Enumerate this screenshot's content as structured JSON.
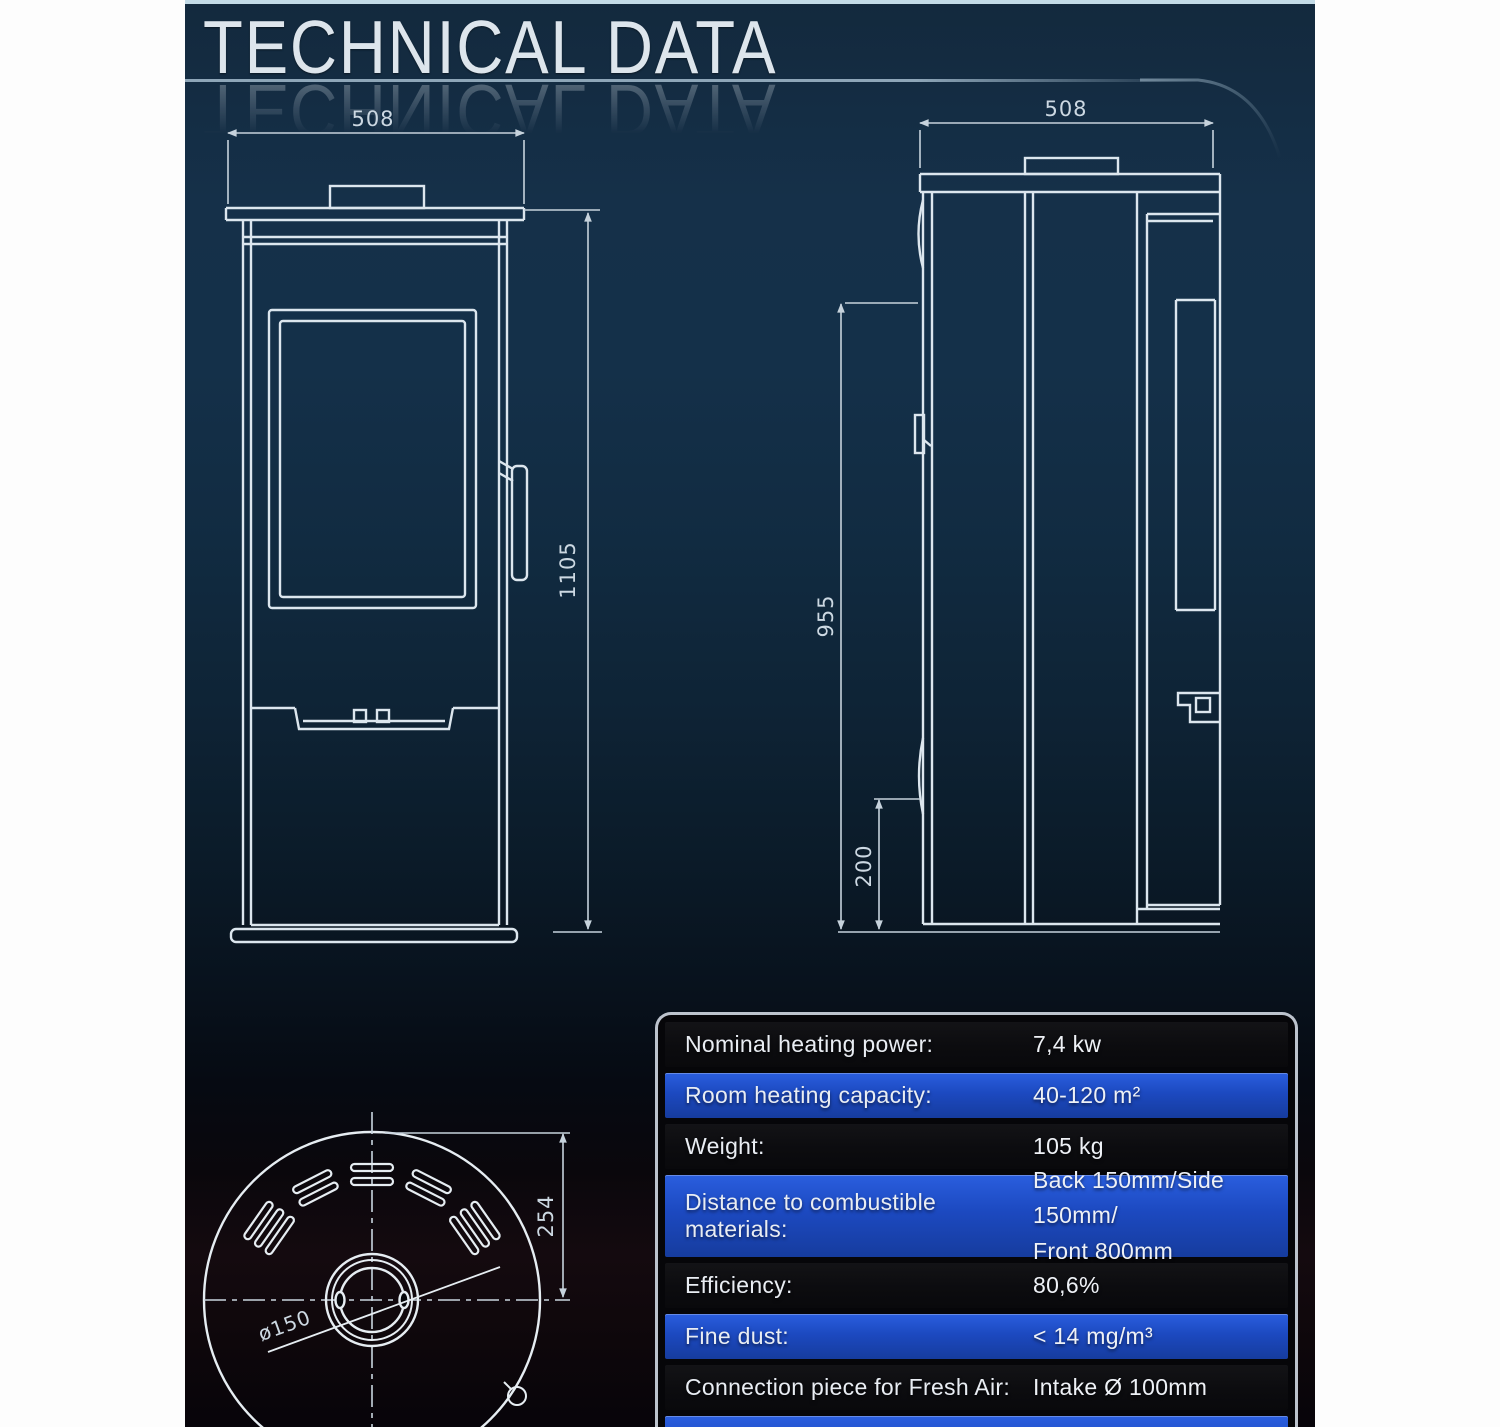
{
  "title": "TECHNICAL DATA",
  "drawings": {
    "front_view": {
      "width_dim": "508",
      "height_dim": "1105"
    },
    "side_view": {
      "width_dim": "508",
      "height_dim": "955",
      "base_dim": "200"
    },
    "top_view": {
      "radius_dim": "254",
      "flue_dim": "ø150"
    }
  },
  "spec_table": {
    "rows": [
      {
        "label": "Nominal heating power:",
        "value": "7,4 kw"
      },
      {
        "label": "Room heating capacity:",
        "value": "40-120 m²"
      },
      {
        "label": "Weight:",
        "value": "105 kg"
      },
      {
        "label": "Distance to combustible materials:",
        "value": "Back 150mm/Side 150mm/",
        "value2": "Front 800mm"
      },
      {
        "label": "Efficiency:",
        "value": "80,6%"
      },
      {
        "label": "Fine dust:",
        "value": "< 14 mg/m³"
      },
      {
        "label": "Connection piece for Fresh Air:",
        "value": "Intake Ø 100mm"
      }
    ]
  },
  "colors": {
    "accent_blue": "#1c49c0",
    "row_dark": "#0d0d10",
    "drawing_line": "#dce6ee",
    "background_top": "#13293d",
    "page_margin": "#fdfdfd"
  }
}
